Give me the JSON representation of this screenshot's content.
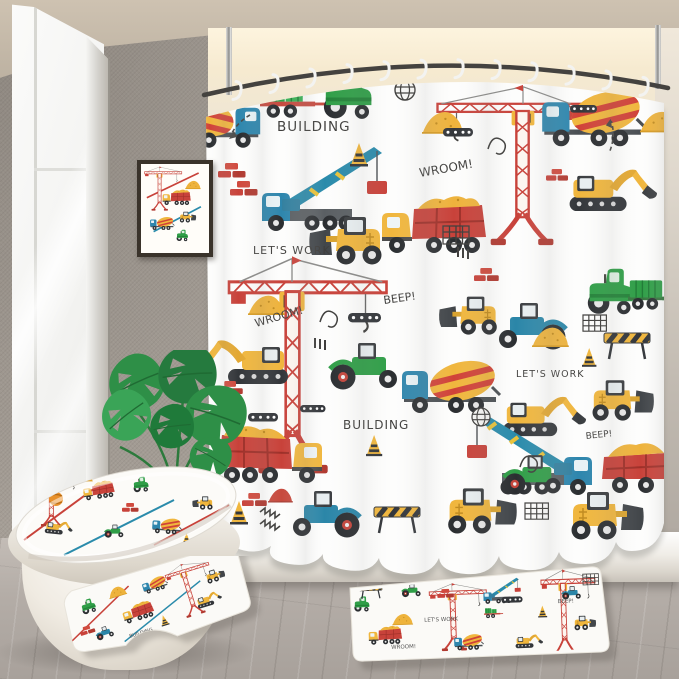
{
  "scene": {
    "texts": {
      "building_top": "BUILDING",
      "wroom_center": "WROOM!",
      "lets_work_left": "LET'S WORK",
      "beep_center": "BEEP!",
      "wroom_left": "WROOM!",
      "lets_work_right": "LET'S WORK",
      "beep_right": "BEEP!",
      "building_bottom": "BUILDING",
      "partial_word_top": "Bo"
    },
    "hook_count": 12,
    "palette": {
      "wall_gray": "#a59e96",
      "ceiling_beige": "#c4b8a7",
      "alcove_warm_light": "#f8ecd4",
      "curtain_white": "#fdfdfc",
      "floor_gray_wood": "#b3aca6",
      "vehicle_red": "#c8423a",
      "vehicle_yellow": "#f0b63d",
      "vehicle_blue": "#2e86ad",
      "boom_teal": "#2a8bab",
      "vehicle_green": "#2f9e47",
      "wheel_black": "#2b2e31",
      "leaf_green": "#2e8f47",
      "rod_dark": "#44423f"
    }
  }
}
